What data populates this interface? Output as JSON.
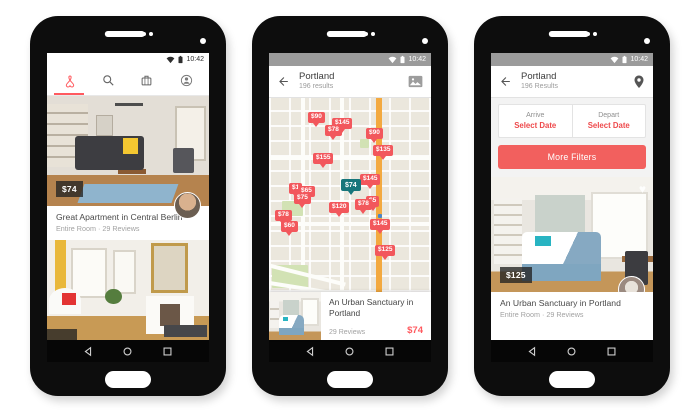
{
  "time": "10:42",
  "colors": {
    "brand_red": "#FF5A5F",
    "pin_red": "#F2575C",
    "pin_teal": "#17767B",
    "filter_red": "#EE4A4C",
    "status_gray": "#9B9B9B"
  },
  "icons": {
    "left_toolbar": [
      "airbnb-logo",
      "search-icon",
      "trips-luggage-icon",
      "profile-icon"
    ],
    "middle_toolbar": [
      "back-arrow-icon",
      "photo-view-icon"
    ],
    "right_toolbar": [
      "back-arrow-icon",
      "map-pin-icon"
    ],
    "status": [
      "wifi-icon",
      "battery-icon"
    ],
    "navbar": [
      "back-icon",
      "home-icon",
      "recents-icon"
    ],
    "photo_overlay": [
      "heart-icon"
    ]
  },
  "left_phone": {
    "listing": {
      "price": "$74",
      "title": "Great Apartment in Central Berlin",
      "subtitle": "Entire Room · 29 Reviews"
    }
  },
  "middle_phone": {
    "toolbar": {
      "title": "Portland",
      "subtitle": "196 results"
    },
    "map_pins": [
      {
        "label": "$90",
        "x": 39,
        "y": 14
      },
      {
        "label": "$145",
        "x": 63,
        "y": 20
      },
      {
        "label": "$78",
        "x": 56,
        "y": 27
      },
      {
        "label": "$90",
        "x": 97,
        "y": 30
      },
      {
        "label": "$135",
        "x": 104,
        "y": 47
      },
      {
        "label": "$155",
        "x": 44,
        "y": 55
      },
      {
        "label": "$145",
        "x": 91,
        "y": 76
      },
      {
        "label": "$1",
        "x": 20,
        "y": 85
      },
      {
        "label": "$65",
        "x": 29,
        "y": 88
      },
      {
        "label": "$75",
        "x": 25,
        "y": 95
      },
      {
        "label": "$74",
        "x": 72,
        "y": 81,
        "style": "teal"
      },
      {
        "label": "$5",
        "x": 97,
        "y": 98
      },
      {
        "label": "$78",
        "x": 86,
        "y": 101
      },
      {
        "label": "$120",
        "x": 60,
        "y": 104
      },
      {
        "label": "$78",
        "x": 6,
        "y": 112
      },
      {
        "label": "$60",
        "x": 12,
        "y": 123
      },
      {
        "label": "$145",
        "x": 101,
        "y": 121
      },
      {
        "label": "$125",
        "x": 106,
        "y": 147
      }
    ],
    "card": {
      "title": "An Urban Sanctuary in Portland",
      "reviews": "29 Reviews",
      "price": "$74"
    }
  },
  "right_phone": {
    "toolbar": {
      "title": "Portland",
      "subtitle": "196 Results"
    },
    "filters": {
      "arrive_label": "Arrive",
      "arrive_value": "Select Date",
      "depart_label": "Depart",
      "depart_value": "Select Date"
    },
    "more_filters_label": "More Filters",
    "listing": {
      "price": "$125",
      "title": "An Urban Sanctuary in Portland",
      "subtitle": "Entire Room · 29 Reviews"
    }
  }
}
